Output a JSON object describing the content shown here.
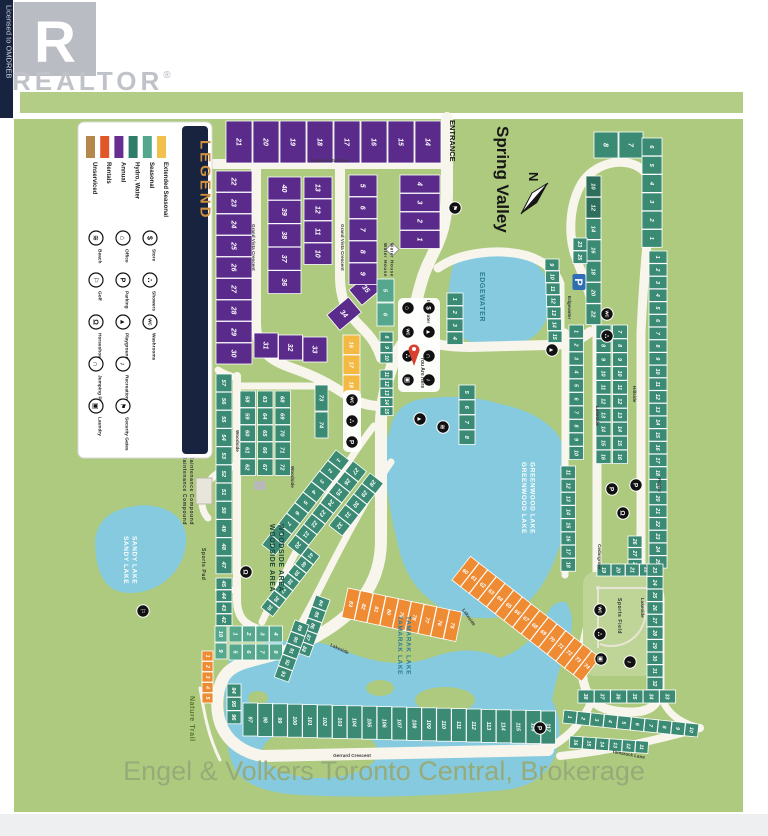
{
  "branding": {
    "logo_letter": "R",
    "logo_text": "REALTOR",
    "registered": "®",
    "licensed": "Licensed to OMDREB"
  },
  "header": {
    "title": "Spring Valley",
    "entrance": "ENTRANCE",
    "north": "N",
    "you_are_here": "You Are Here"
  },
  "attribution": "Engel & Volkers Toronto Central, Brokerage",
  "legend": {
    "title": "LEGEND",
    "site_types": [
      {
        "label": "Unserviced",
        "color": "#b5874b"
      },
      {
        "label": "Rentals",
        "color": "#e2572a"
      },
      {
        "label": "Annual",
        "color": "#682d91"
      },
      {
        "label": "Hydro, Water",
        "color": "#2e7c6a"
      },
      {
        "label": "Seasonal",
        "color": "#53a78d"
      },
      {
        "label": "Extended Seasonal",
        "color": "#f2c14d"
      }
    ],
    "amenities": [
      {
        "label": "Beach",
        "icon": "beach-icon"
      },
      {
        "label": "Golf",
        "icon": "golf-icon"
      },
      {
        "label": "Horseshoes",
        "icon": "horseshoes-icon"
      },
      {
        "label": "Jumping Pillow",
        "icon": "jumping-pillow-icon"
      },
      {
        "label": "Laundry",
        "icon": "laundry-icon"
      },
      {
        "label": "Office",
        "icon": "office-icon"
      },
      {
        "label": "Parking",
        "icon": "parking-icon"
      },
      {
        "label": "Playground",
        "icon": "playground-icon"
      },
      {
        "label": "Recreation Hall",
        "icon": "recreation-hall-icon"
      },
      {
        "label": "Security Gates",
        "icon": "security-gates-icon"
      },
      {
        "label": "Store",
        "icon": "store-icon"
      },
      {
        "label": "Showers",
        "icon": "showers-icon"
      },
      {
        "label": "Washrooms",
        "icon": "washrooms-icon"
      }
    ]
  },
  "colors": {
    "annual": "#5b2b8c",
    "hydro": "#3a8a74",
    "rentals": "#ef8b33",
    "seasonal": "#55a88e",
    "extended": "#f3b942",
    "unserviced": "#c29453",
    "lake": "#85cade",
    "road": "#f7f5ec",
    "map_green": "#aeca7f",
    "navy": "#18243f"
  },
  "map": {
    "lakes": [
      {
        "name": "EDGEWATER"
      },
      {
        "name": "GREENWOOD LAKE"
      },
      {
        "name": "SANDY LAKE"
      },
      {
        "name": "TAMARAK LAKE"
      }
    ],
    "areas": [
      {
        "name": "WOODSIDE AREA"
      }
    ],
    "facilities": [
      {
        "name": "Water House"
      },
      {
        "name": "Maintenance Compound"
      },
      {
        "name": "Sports Pad"
      },
      {
        "name": "Sports Field"
      },
      {
        "name": "Nature Trail"
      }
    ],
    "streets": [
      {
        "name": "Grand Vista Drive"
      },
      {
        "name": "Grand Vista Crescent"
      },
      {
        "name": "Edgewater"
      },
      {
        "name": "Woodside"
      },
      {
        "name": "Lakeside"
      },
      {
        "name": "Hillside"
      },
      {
        "name": "Poplar"
      },
      {
        "name": "Cedargrove"
      },
      {
        "name": "Tamarack Lane"
      },
      {
        "name": "Gerrard Crescent"
      }
    ],
    "icons": [
      {
        "type": "security-gates"
      },
      {
        "type": "parking-sign"
      },
      {
        "type": "washrooms"
      },
      {
        "type": "showers"
      },
      {
        "type": "office"
      },
      {
        "type": "store"
      },
      {
        "type": "washrooms"
      },
      {
        "type": "playground"
      },
      {
        "type": "showers"
      },
      {
        "type": "jumping-pillow"
      },
      {
        "type": "laundry"
      },
      {
        "type": "recreation-hall"
      },
      {
        "type": "washrooms"
      },
      {
        "type": "showers"
      },
      {
        "type": "parking"
      },
      {
        "type": "playground"
      },
      {
        "type": "playground"
      },
      {
        "type": "beach"
      },
      {
        "type": "golf"
      },
      {
        "type": "horseshoes"
      },
      {
        "type": "parking"
      },
      {
        "type": "parking"
      },
      {
        "type": "horseshoes"
      },
      {
        "type": "washrooms"
      },
      {
        "type": "showers"
      },
      {
        "type": "laundry"
      },
      {
        "type": "recreation-hall"
      },
      {
        "type": "parking"
      }
    ],
    "lot_groups": [
      {
        "id": "vista-top",
        "type": "annual",
        "numbers": [
          21,
          20,
          19,
          18,
          17,
          16,
          15,
          14
        ]
      },
      {
        "id": "vista-west",
        "type": "annual",
        "numbers": [
          22,
          23,
          24,
          25,
          26,
          27,
          28,
          29,
          30
        ]
      },
      {
        "id": "vista-south",
        "type": "annual",
        "numbers": [
          31,
          32,
          33
        ]
      },
      {
        "id": "vista-34",
        "type": "annual",
        "numbers": [
          34
        ]
      },
      {
        "id": "vista-35",
        "type": "annual",
        "numbers": [
          35
        ]
      },
      {
        "id": "vista-mid-a",
        "type": "annual",
        "numbers": [
          40,
          39,
          38,
          37,
          36
        ]
      },
      {
        "id": "vista-mid-b",
        "type": "annual",
        "numbers": [
          13,
          12,
          11,
          10
        ]
      },
      {
        "id": "vista-east-a",
        "type": "annual",
        "numbers": [
          5,
          6,
          7,
          8,
          9
        ]
      },
      {
        "id": "vista-east-b",
        "type": "annual",
        "numbers": [
          4,
          3,
          2,
          1
        ]
      },
      {
        "id": "extended-16-18",
        "type": "extended",
        "numbers": [
          16,
          17,
          18
        ]
      },
      {
        "id": "rentals-1-5",
        "type": "rentals",
        "numbers": [
          1,
          2,
          3,
          4,
          5
        ]
      },
      {
        "id": "seasonal-5-6",
        "type": "seasonal",
        "numbers": [
          5,
          6
        ]
      },
      {
        "id": "seasonal-row-a",
        "type": "seasonal",
        "numbers": [
          1,
          2,
          3,
          4
        ]
      },
      {
        "id": "seasonal-row-b",
        "type": "seasonal",
        "numbers": [
          5,
          6,
          7,
          8
        ]
      },
      {
        "id": "seasonal-9-10",
        "type": "seasonal",
        "numbers": [
          10,
          9
        ]
      },
      {
        "id": "edge-1-4",
        "type": "hydro",
        "numbers": [
          1,
          2,
          3,
          4
        ]
      },
      {
        "id": "edge-5-8",
        "type": "hydro",
        "numbers": [
          5,
          6,
          7,
          8
        ]
      },
      {
        "id": "edge-8-10",
        "type": "hydro",
        "numbers": [
          8,
          9,
          10
        ]
      },
      {
        "id": "edge-11-15",
        "type": "hydro",
        "numbers": [
          11,
          12,
          13,
          14,
          15
        ]
      },
      {
        "id": "edge-9-15",
        "type": "hydro",
        "numbers": [
          9,
          10,
          11,
          12,
          13,
          14,
          15
        ]
      },
      {
        "id": "woodside-w1",
        "type": "hydro",
        "numbers": [
          57,
          56,
          55,
          54,
          53,
          52,
          51,
          50,
          49,
          48,
          47
        ]
      },
      {
        "id": "woodside-w2",
        "type": "hydro",
        "numbers": [
          45,
          44,
          43,
          42
        ]
      },
      {
        "id": "woodside-c1",
        "type": "hydro",
        "numbers": [
          58,
          59,
          60,
          61,
          62
        ]
      },
      {
        "id": "woodside-c2",
        "type": "hydro",
        "numbers": [
          63,
          64,
          65,
          66,
          67
        ]
      },
      {
        "id": "woodside-c3",
        "type": "hydro",
        "numbers": [
          68,
          69,
          70,
          71,
          72
        ]
      },
      {
        "id": "woodside-73-74",
        "type": "hydro",
        "numbers": [
          73,
          74
        ]
      },
      {
        "id": "woodside-d1",
        "type": "hydro",
        "numbers": [
          1,
          2,
          3,
          4,
          5,
          6,
          7,
          8,
          9
        ]
      },
      {
        "id": "woodside-d2",
        "type": "hydro",
        "numbers": [
          27,
          26,
          25,
          24,
          23,
          22,
          21,
          20
        ]
      },
      {
        "id": "woodside-d3",
        "type": "hydro",
        "numbers": [
          28,
          29,
          30,
          31,
          32
        ]
      },
      {
        "id": "woodside-d4",
        "type": "hydro",
        "numbers": [
          41,
          40,
          39,
          38,
          37,
          36,
          35
        ]
      },
      {
        "id": "tam-84-88",
        "type": "hydro",
        "numbers": [
          84,
          85,
          86,
          87,
          88
        ]
      },
      {
        "id": "tam-89-93",
        "type": "hydro",
        "numbers": [
          89,
          90,
          91,
          92,
          93
        ]
      },
      {
        "id": "tam-94-96",
        "type": "hydro",
        "numbers": [
          94,
          95,
          96
        ]
      },
      {
        "id": "gerrard-strip",
        "type": "hydro",
        "numbers": [
          97,
          98,
          99,
          100,
          101,
          102,
          103,
          104,
          105,
          106,
          107,
          108,
          109,
          110,
          111,
          112,
          113,
          114,
          115,
          116,
          117
        ]
      },
      {
        "id": "rentals-60-74",
        "type": "rentals",
        "numbers": [
          60,
          61,
          62,
          63,
          64,
          65,
          66,
          67,
          68,
          69,
          70,
          71,
          72,
          73,
          74
        ]
      },
      {
        "id": "rentals-75-83",
        "type": "rentals",
        "numbers": [
          83,
          82,
          81,
          80,
          79,
          78,
          77,
          76,
          75
        ]
      },
      {
        "id": "ne-7-8",
        "type": "hydro",
        "numbers": [
          8,
          7
        ]
      },
      {
        "id": "ne-even",
        "type": "hydro",
        "numbers": [
          10,
          12,
          14,
          16,
          18,
          20,
          22
        ]
      },
      {
        "id": "ne-1-6",
        "type": "hydro",
        "numbers": [
          6,
          5,
          4,
          3,
          2,
          1
        ]
      },
      {
        "id": "ne-23-25",
        "type": "hydro",
        "numbers": [
          23,
          25
        ]
      },
      {
        "id": "east-1-25",
        "type": "hydro",
        "numbers": [
          1,
          2,
          3,
          4,
          5,
          6,
          7,
          8,
          9,
          10,
          11,
          12,
          13,
          14,
          15,
          16,
          17,
          18,
          19,
          20,
          21,
          22,
          23,
          24,
          25
        ]
      },
      {
        "id": "mid-dbl-a",
        "type": "hydro",
        "numbers": [
          7,
          8,
          9,
          10,
          11,
          12,
          13,
          14,
          15,
          16
        ]
      },
      {
        "id": "mid-dbl-b",
        "type": "hydro",
        "numbers": [
          7,
          8,
          9,
          10,
          11,
          12,
          13,
          14,
          15,
          16
        ]
      },
      {
        "id": "lake-1-10",
        "type": "hydro",
        "numbers": [
          1,
          2,
          3,
          4,
          5,
          6,
          7,
          8,
          9,
          10
        ]
      },
      {
        "id": "lake-11-18",
        "type": "hydro",
        "numbers": [
          11,
          12,
          13,
          14,
          15,
          16,
          17,
          18
        ]
      },
      {
        "id": "mid-26-28",
        "type": "hydro",
        "numbers": [
          26,
          27,
          28
        ]
      },
      {
        "id": "sf-19-22",
        "type": "hydro",
        "numbers": [
          19,
          20,
          21,
          22
        ]
      },
      {
        "id": "sf-23-32",
        "type": "hydro",
        "numbers": [
          23,
          24,
          25,
          26,
          27,
          28,
          29,
          30,
          31,
          32
        ]
      },
      {
        "id": "sf-33-38",
        "type": "hydro",
        "numbers": [
          38,
          37,
          36,
          35,
          34,
          33
        ]
      },
      {
        "id": "se-1-10",
        "type": "hydro",
        "numbers": [
          1,
          2,
          3,
          4,
          5,
          6,
          7,
          8,
          9,
          10
        ]
      },
      {
        "id": "se-11-16",
        "type": "hydro",
        "numbers": [
          16,
          15,
          14,
          13,
          12,
          11
        ]
      }
    ]
  }
}
